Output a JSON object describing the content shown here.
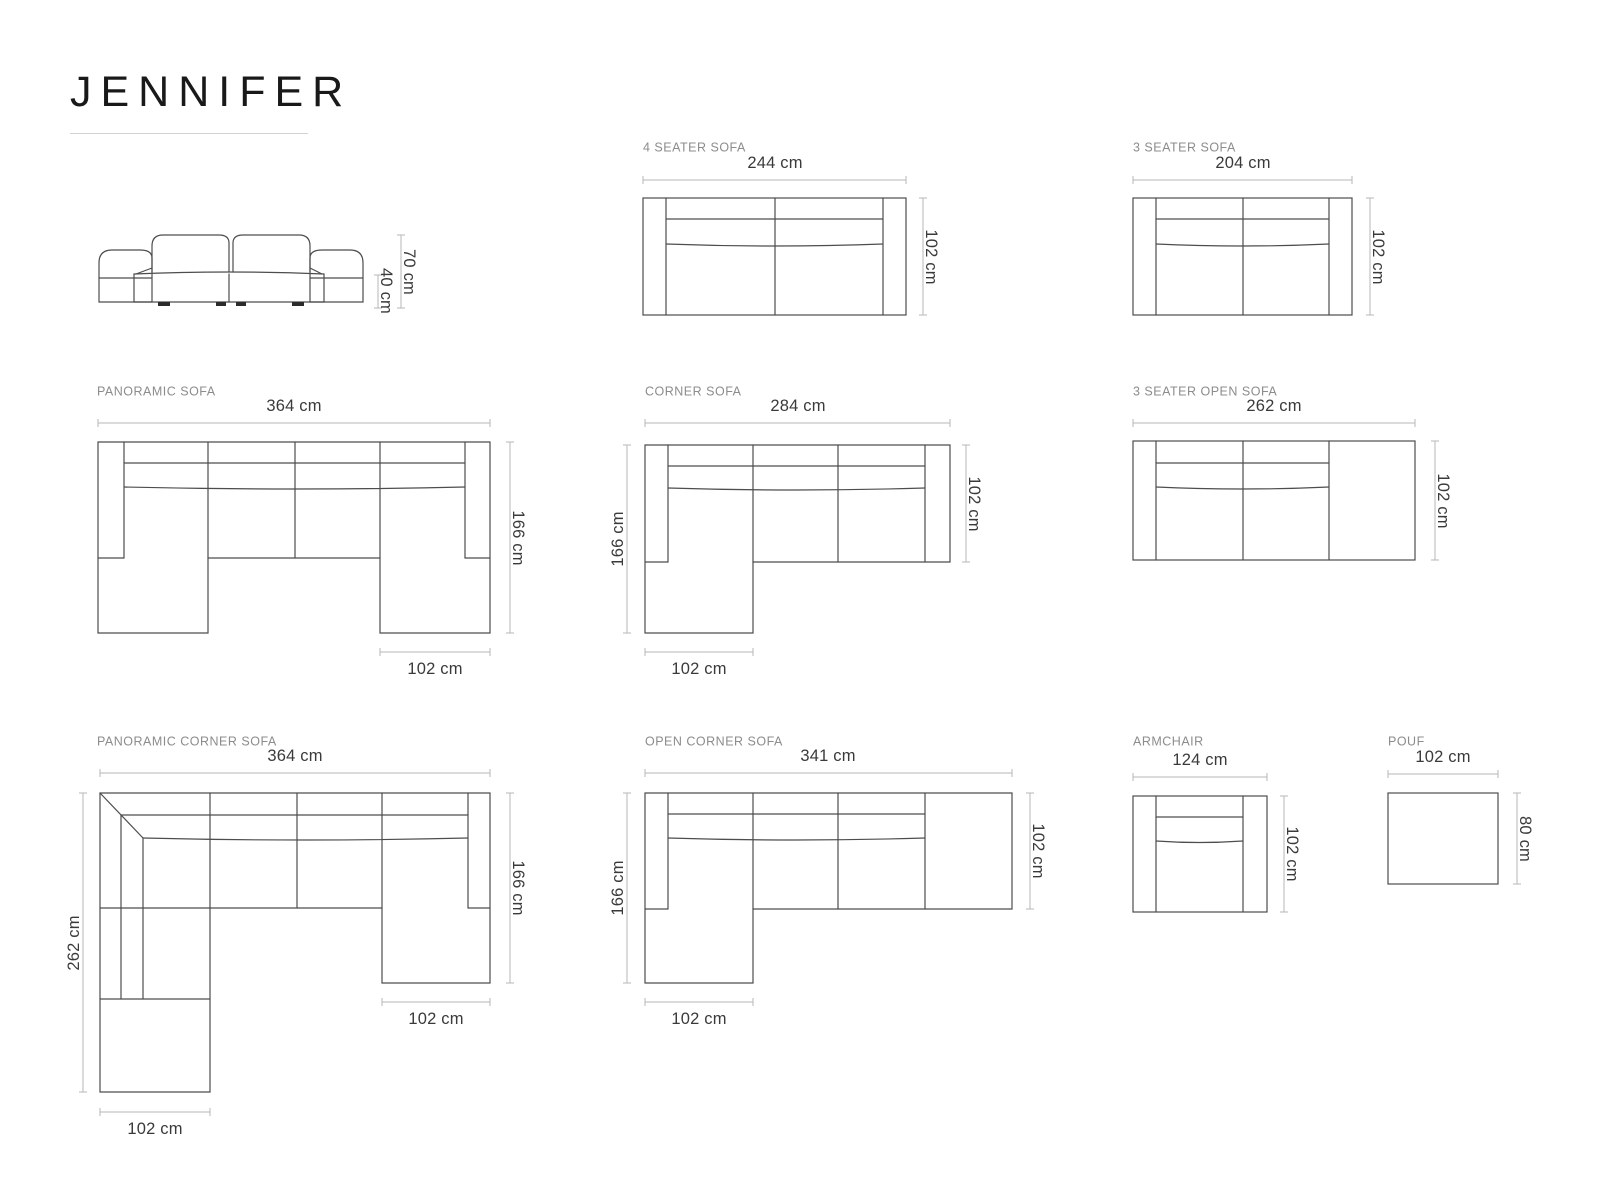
{
  "title": "JENNIFER",
  "colors": {
    "background": "#ffffff",
    "sofa_outline": "#4d4d4d",
    "dimension_line": "#b7b7b7",
    "dimension_text": "#3a3a3a",
    "section_label": "#8c8c8c",
    "title_text": "#191919"
  },
  "front_view": {
    "total_height": "70 cm",
    "seat_height": "40 cm"
  },
  "diagrams": {
    "four_seater": {
      "label": "4 SEATER SOFA",
      "width": "244 cm",
      "depth": "102 cm"
    },
    "three_seater": {
      "label": "3 SEATER SOFA",
      "width": "204 cm",
      "depth": "102 cm"
    },
    "panoramic": {
      "label": "PANORAMIC SOFA",
      "width": "364 cm",
      "depth": "166 cm",
      "chaise_width": "102 cm"
    },
    "corner": {
      "label": "CORNER SOFA",
      "width": "284 cm",
      "seat_depth": "102 cm",
      "total_depth": "166 cm",
      "chaise_width": "102 cm"
    },
    "three_seater_open": {
      "label": "3 SEATER OPEN SOFA",
      "width": "262 cm",
      "depth": "102 cm"
    },
    "panoramic_corner": {
      "label": "PANORAMIC CORNER SOFA",
      "width": "364 cm",
      "total_depth": "262 cm",
      "right_depth": "166 cm",
      "right_chaise_width": "102 cm",
      "left_chaise_width": "102 cm"
    },
    "open_corner": {
      "label": "OPEN CORNER SOFA",
      "width": "341 cm",
      "total_depth": "166 cm",
      "seat_depth": "102 cm",
      "chaise_width": "102 cm"
    },
    "armchair": {
      "label": "ARMCHAIR",
      "width": "124 cm",
      "depth": "102 cm"
    },
    "pouf": {
      "label": "POUF",
      "width": "102 cm",
      "depth": "80 cm"
    }
  }
}
